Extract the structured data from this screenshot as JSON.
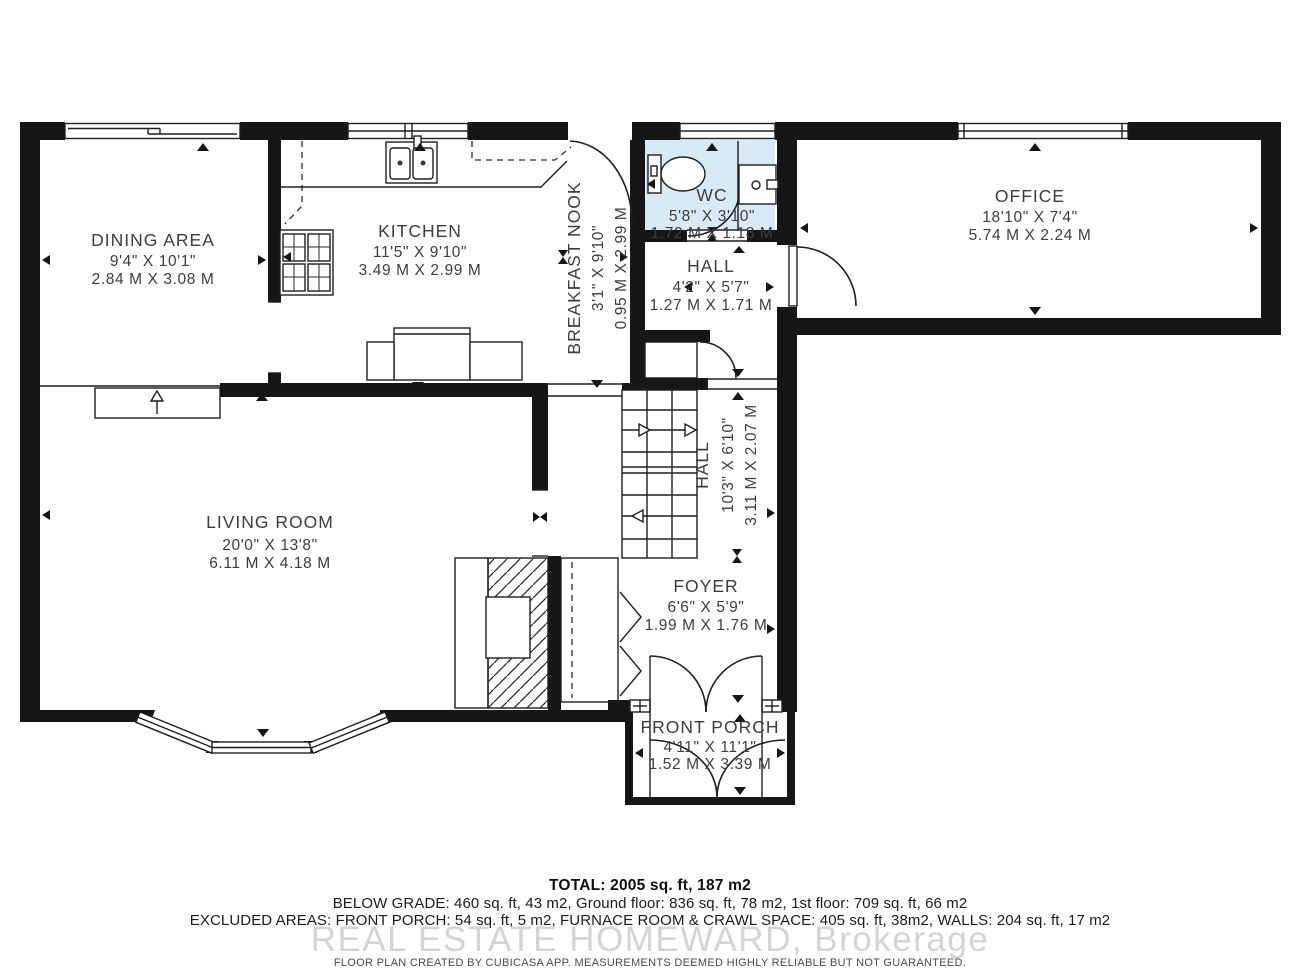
{
  "colors": {
    "wall": "#161616",
    "wc_fill": "#d9eaf7",
    "label": "#3d3d3d",
    "watermark": "#c9c9c9"
  },
  "rooms": {
    "dining": {
      "name": "DINING AREA",
      "imperial": "9'4\" X 10'1\"",
      "metric": "2.84 M X 3.08 M"
    },
    "kitchen": {
      "name": "KITCHEN",
      "imperial": "11'5\" X 9'10\"",
      "metric": "3.49 M X 2.99 M"
    },
    "breakfast_nook": {
      "name": "BREAKFAST NOOK",
      "imperial": "3'1\" X 9'10\"",
      "metric": "0.95 M X 2.99 M"
    },
    "wc": {
      "name": "WC",
      "imperial": "5'8\" X 3'10\"",
      "metric": "1.72 M X 1.18 M"
    },
    "hall_upper": {
      "name": "HALL",
      "imperial": "4'2\" X 5'7\"",
      "metric": "1.27 M X 1.71 M"
    },
    "office": {
      "name": "OFFICE",
      "imperial": "18'10\" X 7'4\"",
      "metric": "5.74 M X 2.24 M"
    },
    "living_room": {
      "name": "LIVING ROOM",
      "imperial": "20'0\" X 13'8\"",
      "metric": "6.11 M X 4.18 M"
    },
    "hall_lower": {
      "name": "HALL",
      "imperial": "10'3\" X 6'10\"",
      "metric": "3.11 M X 2.07 M"
    },
    "foyer": {
      "name": "FOYER",
      "imperial": "6'6\" X 5'9\"",
      "metric": "1.99 M X 1.76 M"
    },
    "front_porch": {
      "name": "FRONT PORCH",
      "imperial": "4'11\" X 11'1\"",
      "metric": "1.52 M X 3.39 M"
    }
  },
  "summary": {
    "total": "TOTAL: 2005 sq. ft, 187 m2",
    "floors": "BELOW GRADE: 460 sq. ft, 43 m2, Ground floor: 836 sq. ft, 78 m2, 1st floor: 709 sq. ft, 66 m2",
    "excluded": "EXCLUDED AREAS: FRONT PORCH: 54 sq. ft, 5 m2, FURNACE ROOM & CRAWL SPACE: 405 sq. ft, 38m2, WALLS: 204 sq. ft, 17 m2"
  },
  "watermark": "REAL ESTATE HOMEWARD, Brokerage",
  "disclaimer": "FLOOR PLAN CREATED BY CUBICASA APP. MEASUREMENTS DEEMED HIGHLY RELIABLE BUT NOT GUARANTEED."
}
